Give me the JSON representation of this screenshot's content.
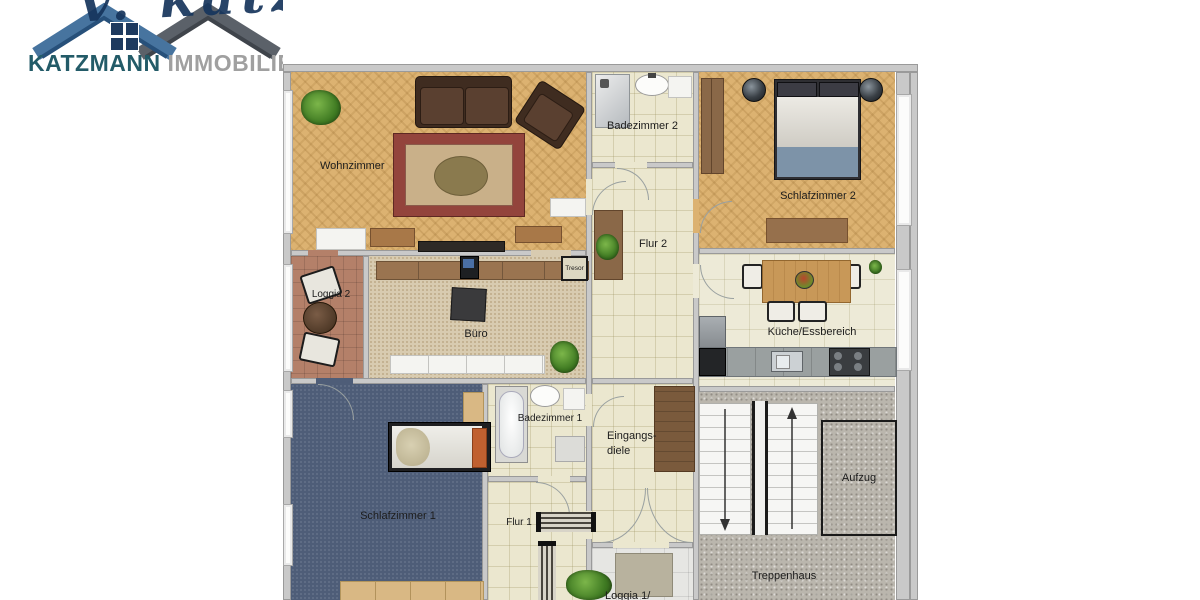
{
  "logo": {
    "watermark_text": "v. katzm",
    "brand": "KATZMANN",
    "brand_suffix": "IMMOBILIEN",
    "colors": {
      "roof_blue": "#47749f",
      "roof_blue_dark": "#27507a",
      "roof_gray": "#5b6169",
      "roof_gray_dark": "#3f444b",
      "window_pane": "#1e3a5f",
      "brand_text": "#235b68",
      "brand_suffix_text": "#a0a0a0",
      "watermark": "#16355c"
    }
  },
  "floorplan": {
    "rooms": [
      {
        "id": "wohnzimmer",
        "label": "Wohnzimmer",
        "furniture": [
          "plant",
          "sofa",
          "armchair",
          "oriental-rug",
          "sideboard",
          "tv-lowboard",
          "sideboard",
          "radiator"
        ]
      },
      {
        "id": "badezimmer2",
        "label": "Badezimmer 2",
        "furniture": [
          "shower",
          "washbasin",
          "toilet"
        ]
      },
      {
        "id": "schlafzimmer2",
        "label": "Schlafzimmer 2",
        "furniture": [
          "wardrobe",
          "plant-pot",
          "double-bed",
          "plant-pot",
          "sideboard"
        ]
      },
      {
        "id": "flur2",
        "label": "Flur 2",
        "furniture": [
          "cabinet",
          "plant"
        ]
      },
      {
        "id": "loggia2",
        "label": "Loggia 2",
        "furniture": [
          "chair",
          "round-table",
          "chair"
        ]
      },
      {
        "id": "buero",
        "label": "Büro",
        "furniture": [
          "sideboard",
          "monitor",
          "desk",
          "low-cabinets",
          "plant"
        ]
      },
      {
        "id": "kueche",
        "label": "Küche/Essbereich",
        "furniture": [
          "dining-table",
          "chairs",
          "fruit-bowl",
          "refrigerator",
          "kitchen-counter",
          "sink",
          "stove",
          "plant"
        ]
      },
      {
        "id": "badezimmer1",
        "label": "Badezimmer 1",
        "furniture": [
          "bathtub",
          "washbasin",
          "toilet",
          "shelf"
        ]
      },
      {
        "id": "eingangsdiele",
        "label_line1": "Eingangs-",
        "label_line2": "diele",
        "furniture": [
          "wardrobe"
        ]
      },
      {
        "id": "schlafzimmer1",
        "label": "Schlafzimmer 1",
        "furniture": [
          "single-bed",
          "cabinet",
          "wardrobe"
        ]
      },
      {
        "id": "flur1",
        "label": "Flur 1",
        "furniture": [
          "shelf",
          "shelf"
        ]
      },
      {
        "id": "loggia1",
        "label": "Loggia 1/",
        "furniture": [
          "plant",
          "floor-mat"
        ]
      },
      {
        "id": "treppenhaus",
        "label": "Treppenhaus",
        "furniture": [
          "staircase-down",
          "staircase-up"
        ]
      },
      {
        "id": "aufzug",
        "label": "Aufzug",
        "furniture": []
      },
      {
        "id": "tresor",
        "label": "Tresor",
        "furniture": []
      }
    ],
    "icons": {
      "stairs_down": "arrow-down",
      "stairs_up": "arrow-up"
    },
    "floor_colors": {
      "wood_herringbone": "#dcb271",
      "tile_beige": "#ebe7cf",
      "tile_kitchen": "#edead7",
      "loggia2_tile": "#b48069",
      "office_carpet": "#d8cbb0",
      "bedroom1_carpet": "#4e5d78",
      "stairwell_concrete": "#bab6ad",
      "loggia1_tile": "#e6e6e3",
      "wall": "#c9c9c9"
    }
  }
}
